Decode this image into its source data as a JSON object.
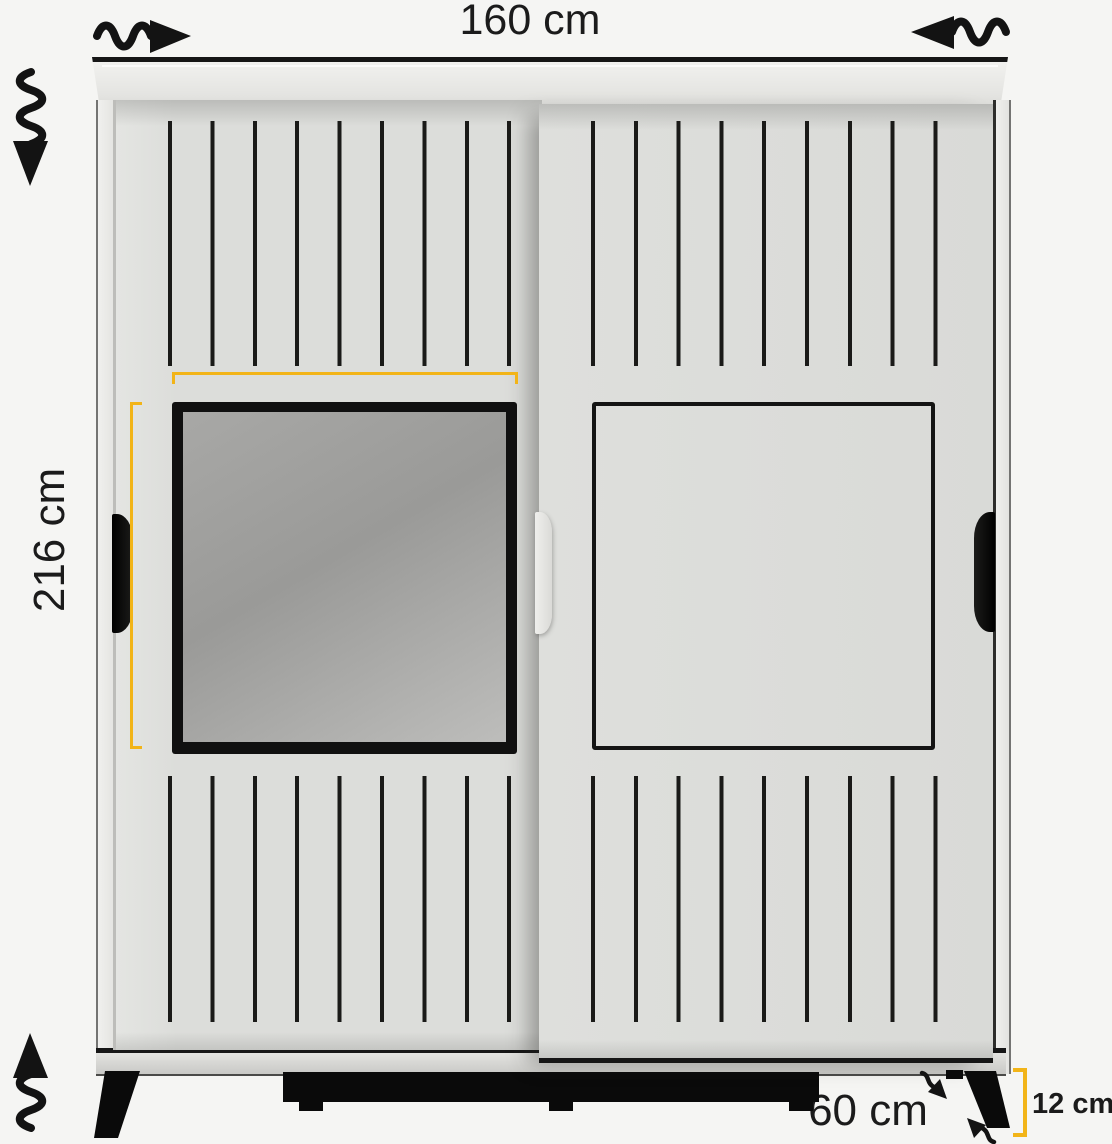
{
  "meta": {
    "description": "Sliding two-door wardrobe with mirror — product dimension diagram"
  },
  "labels": {
    "width": "160 cm",
    "height": "216 cm",
    "mirror_width": "59 cm",
    "mirror_height": "69 cm",
    "depth": "60 cm",
    "leg_height": "12 cm"
  },
  "colors": {
    "background": "#f5f5f3",
    "accent_dimension": "#f2b418",
    "outline": "#161616",
    "door": "#dddedb",
    "mirror": "#9a9a98"
  },
  "icons": {
    "slide_right_wavy_arrow": "↝",
    "slide_left_wavy_arrow": "↜",
    "height_down_wavy_arrow": "⇣",
    "height_up_wavy_arrow": "⇡",
    "leg_pointer_down_arrow": "↘",
    "leg_pointer_up_arrow": "↖"
  }
}
